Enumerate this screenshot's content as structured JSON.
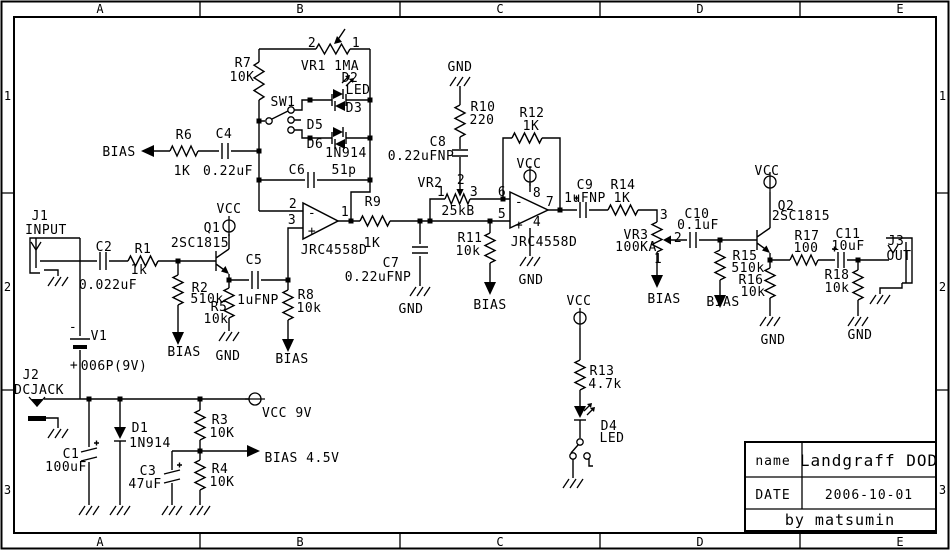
{
  "colors": {
    "ink": "#000000",
    "paper": "#ffffff"
  },
  "frame": {
    "top_letters": [
      "A",
      "B",
      "C",
      "D",
      "E"
    ],
    "bottom_letters": [
      "A",
      "B",
      "C",
      "D",
      "E"
    ],
    "side_numbers": [
      "1",
      "2",
      "3"
    ]
  },
  "title_block": {
    "name_label": "name",
    "name_value": "Landgraff DOD",
    "date_label": "DATE",
    "date_value": "2006-10-01",
    "credit": "by matsumin"
  },
  "schematic": {
    "labels": [
      {
        "id": "vr1-pin2",
        "t": "2",
        "x": 312,
        "y": 47
      },
      {
        "id": "vr1-pin1",
        "t": "1",
        "x": 356,
        "y": 47
      },
      {
        "id": "vr1-name",
        "t": "VR1 1MA",
        "x": 330,
        "y": 70
      },
      {
        "id": "r7-name",
        "t": "R7",
        "x": 243,
        "y": 67
      },
      {
        "id": "r7-val",
        "t": "10K",
        "x": 242,
        "y": 81
      },
      {
        "id": "sw1-name",
        "t": "SW1",
        "x": 283,
        "y": 106
      },
      {
        "id": "d2-name",
        "t": "D2",
        "x": 350,
        "y": 82
      },
      {
        "id": "d2-type",
        "t": "LED",
        "x": 358,
        "y": 94
      },
      {
        "id": "d3-name",
        "t": "D3",
        "x": 354,
        "y": 112
      },
      {
        "id": "d5-name",
        "t": "D5",
        "x": 315,
        "y": 129
      },
      {
        "id": "d6-name",
        "t": "D6",
        "x": 315,
        "y": 148
      },
      {
        "id": "d56-type",
        "t": "1N914",
        "x": 346,
        "y": 157
      },
      {
        "id": "c6-name",
        "t": "C6",
        "x": 297,
        "y": 174
      },
      {
        "id": "c6-val",
        "t": "51p",
        "x": 344,
        "y": 174
      },
      {
        "id": "bias-r6",
        "t": "BIAS",
        "x": 119,
        "y": 156
      },
      {
        "id": "r6-name",
        "t": "R6",
        "x": 184,
        "y": 139
      },
      {
        "id": "r6-val",
        "t": "1K",
        "x": 182,
        "y": 175
      },
      {
        "id": "c4-name",
        "t": "C4",
        "x": 224,
        "y": 138
      },
      {
        "id": "c4-val",
        "t": "0.22uF",
        "x": 228,
        "y": 175
      },
      {
        "id": "j1-name",
        "t": "J1",
        "x": 40,
        "y": 220
      },
      {
        "id": "j1-label",
        "t": "INPUT",
        "x": 46,
        "y": 234
      },
      {
        "id": "c2-name",
        "t": "C2",
        "x": 104,
        "y": 251
      },
      {
        "id": "c2-val",
        "t": "0.022uF",
        "x": 108,
        "y": 289
      },
      {
        "id": "r1-name",
        "t": "R1",
        "x": 143,
        "y": 253
      },
      {
        "id": "r1-val",
        "t": "1k",
        "x": 139,
        "y": 274
      },
      {
        "id": "q1-name",
        "t": "Q1",
        "x": 212,
        "y": 232
      },
      {
        "id": "q1-vcc",
        "t": "VCC",
        "x": 229,
        "y": 213
      },
      {
        "id": "q1-type",
        "t": "2SC1815",
        "x": 200,
        "y": 247
      },
      {
        "id": "r2-name",
        "t": "R2",
        "x": 200,
        "y": 292
      },
      {
        "id": "r2-val",
        "t": "510k",
        "x": 207,
        "y": 303
      },
      {
        "id": "r5-name",
        "t": "R5",
        "x": 219,
        "y": 311
      },
      {
        "id": "r5-val",
        "t": "10k",
        "x": 216,
        "y": 323
      },
      {
        "id": "bias-r2",
        "t": "BIAS",
        "x": 184,
        "y": 356
      },
      {
        "id": "gnd-r5",
        "t": "GND",
        "x": 228,
        "y": 360
      },
      {
        "id": "c5-name",
        "t": "C5",
        "x": 254,
        "y": 264
      },
      {
        "id": "c5-val",
        "t": "1uFNP",
        "x": 258,
        "y": 304
      },
      {
        "id": "r8-name",
        "t": "R8",
        "x": 306,
        "y": 299
      },
      {
        "id": "r8-val",
        "t": "10k",
        "x": 309,
        "y": 312
      },
      {
        "id": "bias-r8",
        "t": "BIAS",
        "x": 292,
        "y": 363
      },
      {
        "id": "v1-minus",
        "t": "-",
        "x": 73,
        "y": 331,
        "fs": 16
      },
      {
        "id": "v1-name",
        "t": "V1",
        "x": 99,
        "y": 340
      },
      {
        "id": "v1-plus",
        "t": "+",
        "x": 74,
        "y": 369,
        "fs": 16
      },
      {
        "id": "v1-type",
        "t": "006P(9V)",
        "x": 114,
        "y": 370
      },
      {
        "id": "j2-name",
        "t": "J2",
        "x": 31,
        "y": 379
      },
      {
        "id": "j2-label",
        "t": "DCJACK",
        "x": 39,
        "y": 394
      },
      {
        "id": "op1-pin2",
        "t": "2",
        "x": 293,
        "y": 208
      },
      {
        "id": "op1-pin3",
        "t": "3",
        "x": 292,
        "y": 224
      },
      {
        "id": "op1-minus",
        "t": "-",
        "x": 312,
        "y": 217,
        "fs": 15
      },
      {
        "id": "op1-plus",
        "t": "+",
        "x": 312,
        "y": 235,
        "fs": 15
      },
      {
        "id": "op1-pin1",
        "t": "1",
        "x": 345,
        "y": 216
      },
      {
        "id": "op1-type",
        "t": "JRC4558D",
        "x": 334,
        "y": 254
      },
      {
        "id": "r9-name",
        "t": "R9",
        "x": 373,
        "y": 206
      },
      {
        "id": "r9-val",
        "t": "1K",
        "x": 372,
        "y": 247
      },
      {
        "id": "c7-name",
        "t": "C7",
        "x": 391,
        "y": 267
      },
      {
        "id": "c7-val",
        "t": "0.22uFNP",
        "x": 378,
        "y": 281
      },
      {
        "id": "gnd-c7",
        "t": "GND",
        "x": 411,
        "y": 313
      },
      {
        "id": "gnd-r10",
        "t": "GND",
        "x": 460,
        "y": 71
      },
      {
        "id": "r10-name",
        "t": "R10",
        "x": 483,
        "y": 111
      },
      {
        "id": "r10-val",
        "t": "220",
        "x": 482,
        "y": 124
      },
      {
        "id": "c8-name",
        "t": "C8",
        "x": 438,
        "y": 146
      },
      {
        "id": "c8-val",
        "t": "0.22uFNP",
        "x": 421,
        "y": 160
      },
      {
        "id": "vr2-name",
        "t": "VR2",
        "x": 430,
        "y": 187
      },
      {
        "id": "vr2-pin2",
        "t": "2",
        "x": 461,
        "y": 184
      },
      {
        "id": "vr2-pin1",
        "t": "1",
        "x": 441,
        "y": 196
      },
      {
        "id": "vr2-pin3",
        "t": "3",
        "x": 474,
        "y": 196
      },
      {
        "id": "vr2-val",
        "t": "25kB",
        "x": 458,
        "y": 215
      },
      {
        "id": "r11-name",
        "t": "R11",
        "x": 470,
        "y": 242
      },
      {
        "id": "r11-val",
        "t": "10k",
        "x": 468,
        "y": 255
      },
      {
        "id": "bias-r11",
        "t": "BIAS",
        "x": 490,
        "y": 309
      },
      {
        "id": "r12-name",
        "t": "R12",
        "x": 532,
        "y": 117
      },
      {
        "id": "r12-val",
        "t": "1K",
        "x": 531,
        "y": 130
      },
      {
        "id": "op2-vcc",
        "t": "VCC",
        "x": 529,
        "y": 168
      },
      {
        "id": "op2-pin6",
        "t": "6",
        "x": 502,
        "y": 196
      },
      {
        "id": "op2-pin5",
        "t": "5",
        "x": 502,
        "y": 218
      },
      {
        "id": "op2-pin8",
        "t": "8",
        "x": 537,
        "y": 197
      },
      {
        "id": "op2-pin4",
        "t": "4",
        "x": 537,
        "y": 226
      },
      {
        "id": "op2-pin7",
        "t": "7",
        "x": 550,
        "y": 206
      },
      {
        "id": "op2-minus",
        "t": "-",
        "x": 519,
        "y": 206,
        "fs": 15
      },
      {
        "id": "op2-plus",
        "t": "+",
        "x": 519,
        "y": 229,
        "fs": 15
      },
      {
        "id": "op2-type",
        "t": "JRC4558D",
        "x": 544,
        "y": 246
      },
      {
        "id": "gnd-op2",
        "t": "GND",
        "x": 531,
        "y": 284
      },
      {
        "id": "c9-name",
        "t": "C9",
        "x": 585,
        "y": 189
      },
      {
        "id": "c9-val",
        "t": "1uFNP",
        "x": 585,
        "y": 202
      },
      {
        "id": "r14-name",
        "t": "R14",
        "x": 623,
        "y": 189
      },
      {
        "id": "r14-val",
        "t": "1K",
        "x": 622,
        "y": 202
      },
      {
        "id": "vr3-pin3",
        "t": "3",
        "x": 664,
        "y": 219
      },
      {
        "id": "vr3-name",
        "t": "VR3",
        "x": 636,
        "y": 239
      },
      {
        "id": "vr3-val",
        "t": "100KA",
        "x": 636,
        "y": 251
      },
      {
        "id": "vr3-pin2",
        "t": "2",
        "x": 678,
        "y": 242
      },
      {
        "id": "vr3-pin1",
        "t": "1",
        "x": 658,
        "y": 263
      },
      {
        "id": "bias-vr3",
        "t": "BIAS",
        "x": 664,
        "y": 303
      },
      {
        "id": "c10-name",
        "t": "C10",
        "x": 697,
        "y": 218
      },
      {
        "id": "c10-val",
        "t": "0.1uF",
        "x": 698,
        "y": 229
      },
      {
        "id": "r15-name",
        "t": "R15",
        "x": 745,
        "y": 260
      },
      {
        "id": "r15-val",
        "t": "510k",
        "x": 748,
        "y": 272
      },
      {
        "id": "bias-r15",
        "t": "BIAS",
        "x": 723,
        "y": 306
      },
      {
        "id": "q2-vcc",
        "t": "VCC",
        "x": 767,
        "y": 175
      },
      {
        "id": "q2-name",
        "t": "Q2",
        "x": 786,
        "y": 210
      },
      {
        "id": "q2-type",
        "t": "2SC1815",
        "x": 801,
        "y": 220
      },
      {
        "id": "r16-name",
        "t": "R16",
        "x": 751,
        "y": 284
      },
      {
        "id": "r16-val",
        "t": "10k",
        "x": 753,
        "y": 296
      },
      {
        "id": "gnd-r16",
        "t": "GND",
        "x": 773,
        "y": 344
      },
      {
        "id": "r17-name",
        "t": "R17",
        "x": 807,
        "y": 240
      },
      {
        "id": "r17-val",
        "t": "100",
        "x": 806,
        "y": 252
      },
      {
        "id": "c11-name",
        "t": "C11",
        "x": 848,
        "y": 238
      },
      {
        "id": "c11-val",
        "t": "10uF",
        "x": 848,
        "y": 250
      },
      {
        "id": "r18-name",
        "t": "R18",
        "x": 837,
        "y": 279
      },
      {
        "id": "r18-val",
        "t": "10k",
        "x": 837,
        "y": 292
      },
      {
        "id": "gnd-r18",
        "t": "GND",
        "x": 860,
        "y": 339
      },
      {
        "id": "j3-name",
        "t": "J3",
        "x": 896,
        "y": 245
      },
      {
        "id": "j3-label",
        "t": "OUT",
        "x": 899,
        "y": 260
      },
      {
        "id": "led-vcc",
        "t": "VCC",
        "x": 579,
        "y": 305
      },
      {
        "id": "r13-name",
        "t": "R13",
        "x": 602,
        "y": 375
      },
      {
        "id": "r13-val",
        "t": "4.7k",
        "x": 605,
        "y": 388
      },
      {
        "id": "d4-name",
        "t": "D4",
        "x": 609,
        "y": 430
      },
      {
        "id": "d4-type",
        "t": "LED",
        "x": 612,
        "y": 442
      },
      {
        "id": "d1-name",
        "t": "D1",
        "x": 140,
        "y": 432
      },
      {
        "id": "d1-type",
        "t": "1N914",
        "x": 150,
        "y": 447
      },
      {
        "id": "c1-name",
        "t": "C1",
        "x": 71,
        "y": 458
      },
      {
        "id": "c1-val",
        "t": "100uF",
        "x": 66,
        "y": 471
      },
      {
        "id": "c3-name",
        "t": "C3",
        "x": 148,
        "y": 475
      },
      {
        "id": "c3-val",
        "t": "47uF",
        "x": 145,
        "y": 488
      },
      {
        "id": "r3-name",
        "t": "R3",
        "x": 220,
        "y": 424
      },
      {
        "id": "r3-val",
        "t": "10K",
        "x": 222,
        "y": 437
      },
      {
        "id": "r4-name",
        "t": "R4",
        "x": 220,
        "y": 473
      },
      {
        "id": "r4-val",
        "t": "10K",
        "x": 222,
        "y": 486
      },
      {
        "id": "vcc-9v",
        "t": "VCC 9V",
        "x": 287,
        "y": 417
      },
      {
        "id": "bias-45",
        "t": "BIAS 4.5V",
        "x": 302,
        "y": 462
      }
    ]
  }
}
